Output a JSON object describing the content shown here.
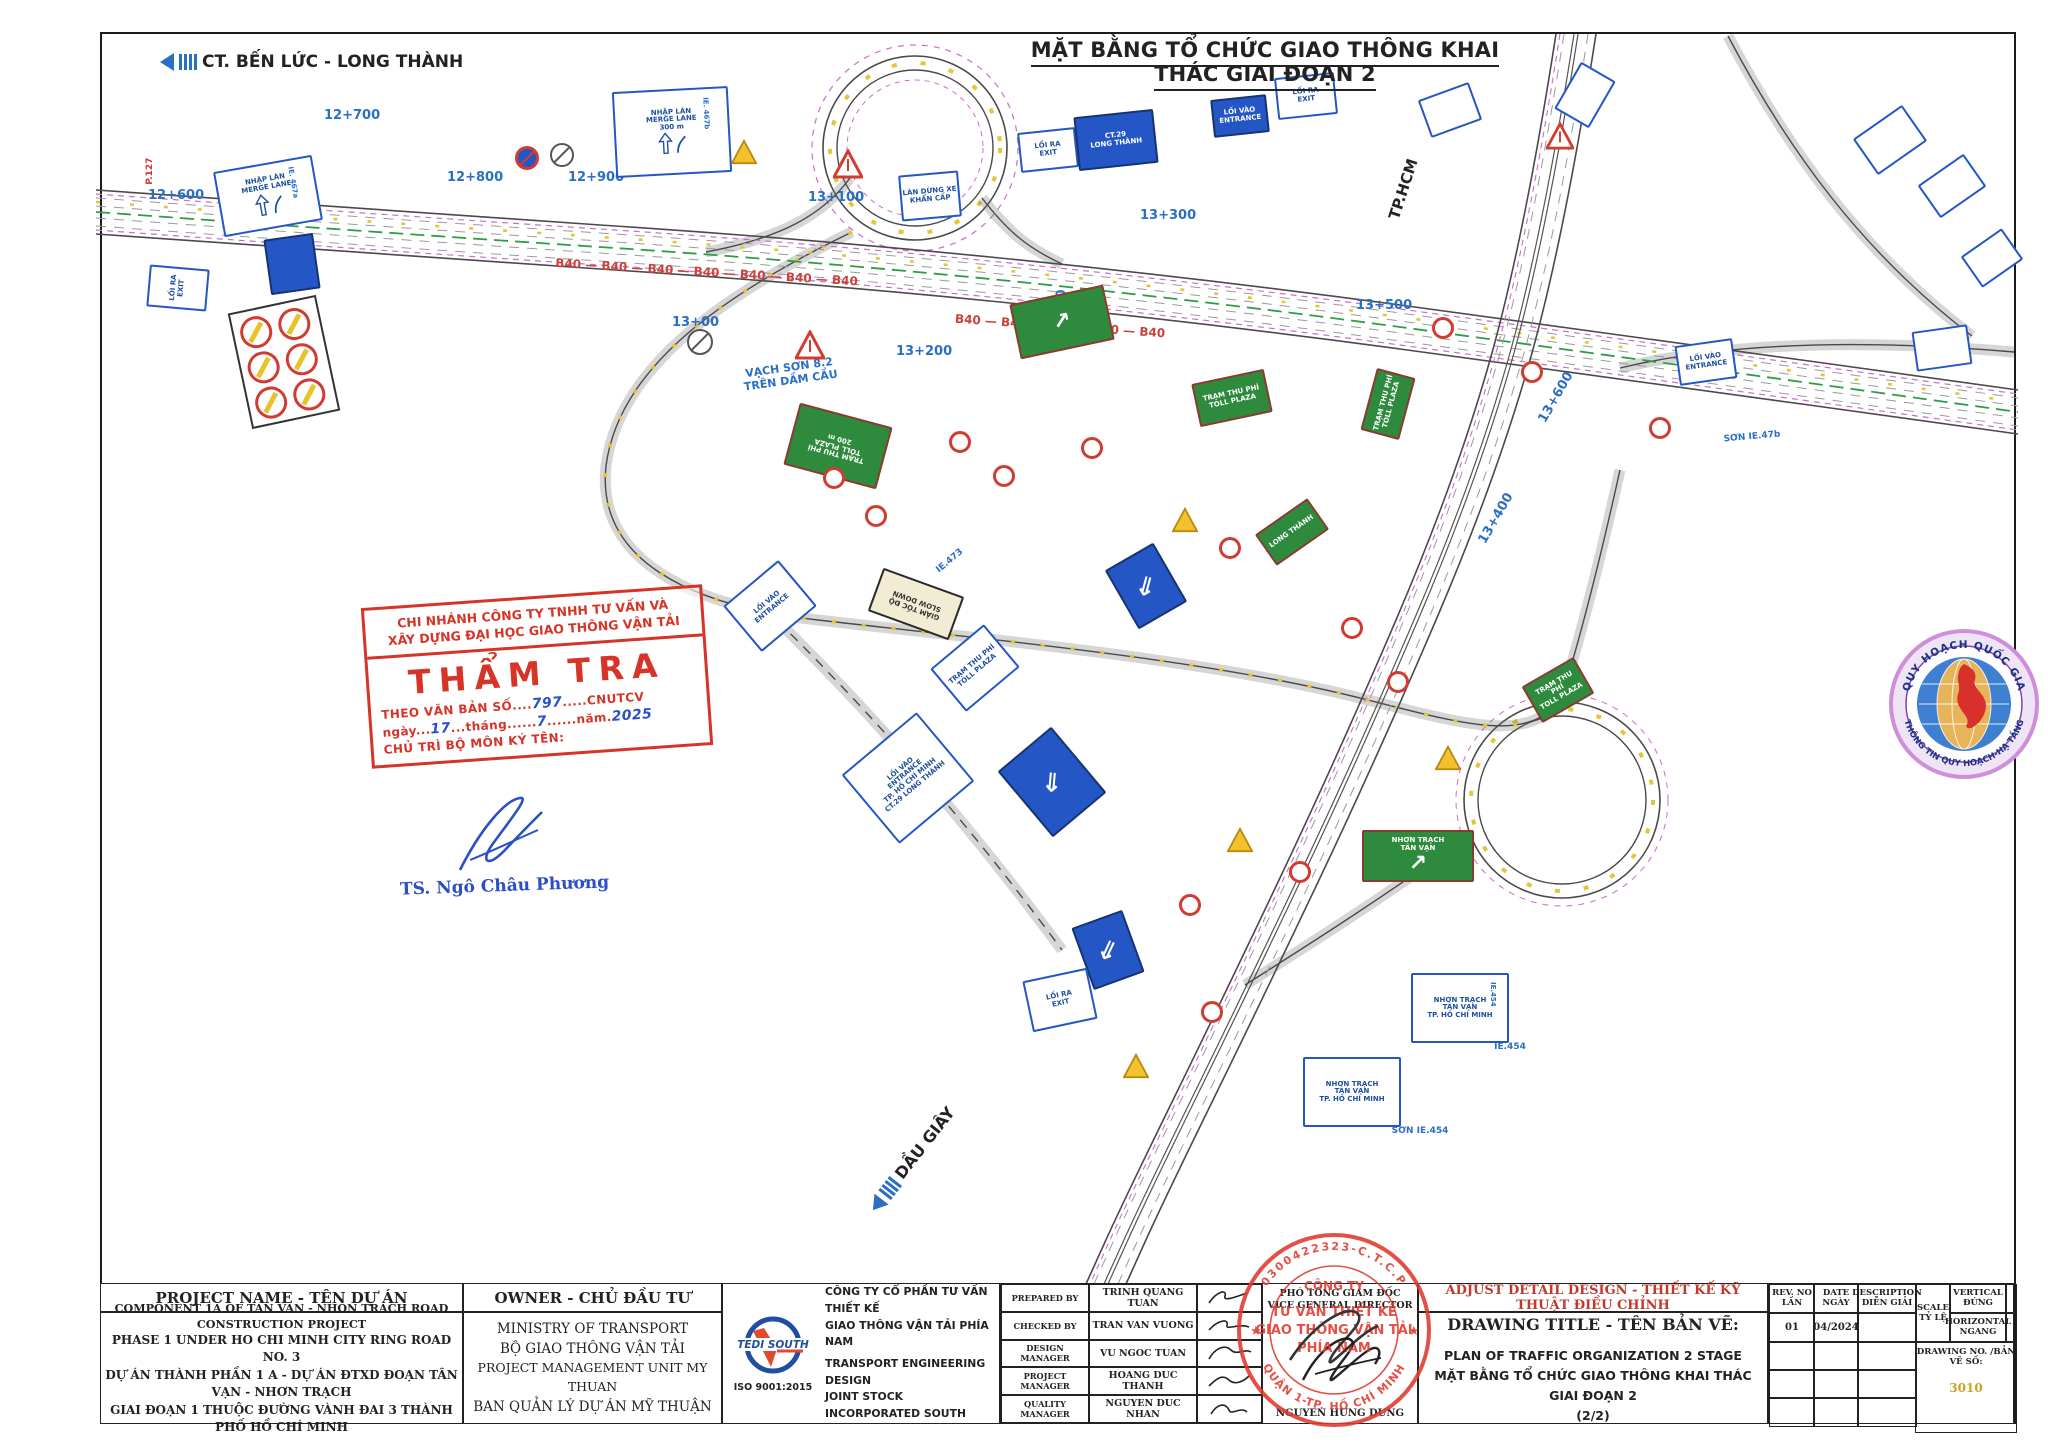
{
  "page": {
    "top_title": "MẶT BẰNG TỔ CHỨC GIAO THÔNG KHAI THÁC GIAI ĐOẠN 2",
    "route_top_left": "CT. BẾN LỨC - LONG THÀNH",
    "route_bottom": "DẦU GIÂY",
    "route_tphcm": "TP.HCM"
  },
  "plan": {
    "chainages": [
      {
        "t": "12+600",
        "x": 176,
        "y": 196,
        "r": 0
      },
      {
        "t": "12+700",
        "x": 352,
        "y": 116,
        "r": 0
      },
      {
        "t": "12+800",
        "x": 475,
        "y": 178,
        "r": 0
      },
      {
        "t": "12+900",
        "x": 596,
        "y": 178,
        "r": 0
      },
      {
        "t": "13+00",
        "x": 700,
        "y": 323,
        "r": 0
      },
      {
        "t": "13+100",
        "x": 836,
        "y": 198,
        "r": 0
      },
      {
        "t": "13+200",
        "x": 924,
        "y": 352,
        "r": 0
      },
      {
        "t": "13+300",
        "x": 1168,
        "y": 216,
        "r": 0
      },
      {
        "t": "13+300",
        "x": 1062,
        "y": 318,
        "r": -90
      },
      {
        "t": "13+400",
        "x": 1496,
        "y": 519,
        "r": -60
      },
      {
        "t": "13+500",
        "x": 1384,
        "y": 306,
        "r": 0
      },
      {
        "t": "13+600",
        "x": 1556,
        "y": 398,
        "r": -60
      }
    ],
    "texts": [
      {
        "t": "VẠCH SƠN 8.2\nTRÊN DẦM CẦU",
        "x": 790,
        "y": 372,
        "r": -8,
        "c": "#2b6fc4",
        "s": 11,
        "b": 1
      },
      {
        "t": "SƠN IE.47b",
        "x": 1752,
        "y": 442,
        "r": -5,
        "c": "#2b6fc4",
        "s": 9,
        "b": 1
      },
      {
        "t": "IE.473",
        "x": 950,
        "y": 566,
        "r": -40,
        "c": "#2b6fc4",
        "s": 9,
        "b": 1
      },
      {
        "t": "SƠN IE.454",
        "x": 1420,
        "y": 1136,
        "r": 0,
        "c": "#2b6fc4",
        "s": 9,
        "b": 1
      },
      {
        "t": "IE.454",
        "x": 1510,
        "y": 1052,
        "r": 0,
        "c": "#2b6fc4",
        "s": 9,
        "b": 1
      },
      {
        "t": "P.127",
        "x": 150,
        "y": 176,
        "r": -90,
        "c": "#cc3333",
        "s": 9,
        "b": 1
      },
      {
        "t": "B40 — B40 — B40 — B40 — B40 — B40 — B40",
        "x": 705,
        "y": 276,
        "r": 3.5,
        "c": "#c8443c",
        "s": 12,
        "b": 1
      },
      {
        "t": "B40 — B40 — B40 — B40 — B40",
        "x": 1060,
        "y": 330,
        "r": 4,
        "c": "#c8443c",
        "s": 12,
        "b": 1
      }
    ],
    "signs": [
      {
        "k": "b",
        "x": 268,
        "y": 196,
        "w": 100,
        "h": 66,
        "r": -10,
        "t": [
          "NHẬP LÀN",
          "MERGE LANE"
        ],
        "tag": "IE. 467a",
        "glyph": "merge"
      },
      {
        "k": "b",
        "x": 672,
        "y": 132,
        "w": 116,
        "h": 86,
        "r": -3,
        "t": [
          "NHẬP LÀN",
          "MERGE LANE",
          "300 m"
        ],
        "tag": "IE. 467b",
        "glyph": "merge"
      },
      {
        "k": "b",
        "x": 930,
        "y": 196,
        "w": 60,
        "h": 46,
        "r": -5,
        "t": [
          "LÀN DỪNG XE",
          "KHẨN CẤP"
        ]
      },
      {
        "k": "b",
        "x": 1048,
        "y": 150,
        "w": 58,
        "h": 40,
        "r": -6,
        "t": [
          "LỐI RA",
          "EXIT"
        ]
      },
      {
        "k": "bf",
        "x": 1116,
        "y": 140,
        "w": 80,
        "h": 54,
        "r": -6,
        "t": [
          "CT.29",
          "LONG THÀNH"
        ]
      },
      {
        "k": "bf",
        "x": 1240,
        "y": 116,
        "w": 56,
        "h": 38,
        "r": -6,
        "t": [
          "LỐI VÀO",
          "ENTRANCE"
        ]
      },
      {
        "k": "b",
        "x": 1306,
        "y": 96,
        "w": 60,
        "h": 42,
        "r": -6,
        "t": [
          "LỐI RA",
          "EXIT"
        ]
      },
      {
        "k": "b",
        "x": 1450,
        "y": 110,
        "w": 54,
        "h": 40,
        "r": -20,
        "t": [
          ""
        ]
      },
      {
        "k": "b",
        "x": 1585,
        "y": 95,
        "w": 54,
        "h": 40,
        "r": -60,
        "t": [
          ""
        ]
      },
      {
        "k": "wt",
        "x": 848,
        "y": 164,
        "s": 30
      },
      {
        "k": "wt",
        "x": 810,
        "y": 345,
        "s": 30
      },
      {
        "k": "wt",
        "x": 1560,
        "y": 136,
        "s": 28
      },
      {
        "k": "yt",
        "x": 744,
        "y": 152,
        "s": 26
      },
      {
        "k": "yt",
        "x": 1185,
        "y": 520,
        "s": 26
      },
      {
        "k": "yt",
        "x": 1240,
        "y": 840,
        "s": 26
      },
      {
        "k": "yt",
        "x": 1136,
        "y": 1066,
        "s": 26
      },
      {
        "k": "yt",
        "x": 1448,
        "y": 758,
        "s": 26
      },
      {
        "k": "nb",
        "x": 527,
        "y": 158,
        "s": 24
      },
      {
        "k": "gc",
        "x": 562,
        "y": 155,
        "s": 24
      },
      {
        "k": "gc",
        "x": 700,
        "y": 342,
        "s": 26
      },
      {
        "k": "g",
        "x": 838,
        "y": 446,
        "w": 96,
        "h": 64,
        "r": 195,
        "t": [
          "TRẠM THU PHÍ",
          "TOLL PLAZA",
          "200 m"
        ]
      },
      {
        "k": "g",
        "x": 1062,
        "y": 322,
        "w": 96,
        "h": 56,
        "r": -12,
        "t": [
          ""
        ],
        "glyph": "garr"
      },
      {
        "k": "g",
        "x": 1232,
        "y": 398,
        "w": 74,
        "h": 44,
        "r": -12,
        "t": [
          "TRẠM THU PHÍ",
          "TOLL PLAZA"
        ]
      },
      {
        "k": "g",
        "x": 1388,
        "y": 404,
        "w": 64,
        "h": 40,
        "r": -75,
        "t": [
          "TRẠM THU PHÍ",
          "TOLL PLAZA"
        ]
      },
      {
        "k": "g",
        "x": 1292,
        "y": 532,
        "w": 64,
        "h": 38,
        "r": -35,
        "t": [
          "LONG THÀNH"
        ]
      },
      {
        "k": "g",
        "x": 1558,
        "y": 690,
        "w": 60,
        "h": 42,
        "r": -30,
        "t": [
          "TRẠM THU PHÍ",
          "TOLL PLAZA"
        ]
      },
      {
        "k": "g",
        "x": 1418,
        "y": 856,
        "w": 112,
        "h": 52,
        "r": 0,
        "t": [
          "NHƠN TRẠCH",
          "TÂN VẠN"
        ],
        "glyph": "garr"
      },
      {
        "k": "bg",
        "x": 916,
        "y": 604,
        "w": 86,
        "h": 46,
        "r": 200,
        "t": [
          "GIẢM TỐC ĐỘ",
          "SLOW DOWN"
        ]
      },
      {
        "k": "b",
        "x": 908,
        "y": 778,
        "w": 98,
        "h": 90,
        "r": -40,
        "t": [
          "LỐI VÀO",
          "ENTRANCE",
          "TP. HỒ CHÍ MINH",
          "CT.29 LONG THÀNH"
        ]
      },
      {
        "k": "arr",
        "x": 1052,
        "y": 782,
        "w": 70,
        "h": 86,
        "r": -40
      },
      {
        "k": "arr",
        "x": 1146,
        "y": 586,
        "w": 56,
        "h": 68,
        "r": -30
      },
      {
        "k": "arr",
        "x": 1108,
        "y": 950,
        "w": 54,
        "h": 66,
        "r": -20
      },
      {
        "k": "b",
        "x": 975,
        "y": 668,
        "w": 70,
        "h": 56,
        "r": -40,
        "t": [
          "TRẠM THU PHÍ",
          "TOLL PLAZA"
        ]
      },
      {
        "k": "b",
        "x": 770,
        "y": 606,
        "w": 72,
        "h": 60,
        "r": -40,
        "t": [
          "LỐI VÀO",
          "ENTRANCE"
        ]
      },
      {
        "k": "b",
        "x": 1060,
        "y": 1000,
        "w": 66,
        "h": 52,
        "r": -12,
        "t": [
          "LỐI RA",
          "EXIT"
        ]
      },
      {
        "k": "b",
        "x": 1460,
        "y": 1008,
        "w": 98,
        "h": 70,
        "r": 0,
        "t": [
          "NHƠN TRẠCH",
          "TÂN VẠN",
          "TP. HỒ CHÍ MINH"
        ],
        "tag": "IE.454"
      },
      {
        "k": "b",
        "x": 1352,
        "y": 1092,
        "w": 98,
        "h": 70,
        "r": 0,
        "t": [
          "NHƠN TRẠCH",
          "TÂN VẠN",
          "TP. HỒ CHÍ MINH"
        ]
      },
      {
        "k": "b",
        "x": 1890,
        "y": 140,
        "w": 60,
        "h": 44,
        "r": -35,
        "t": [
          ""
        ]
      },
      {
        "k": "b",
        "x": 1952,
        "y": 186,
        "w": 56,
        "h": 40,
        "r": -35,
        "t": [
          ""
        ]
      },
      {
        "k": "b",
        "x": 1992,
        "y": 258,
        "w": 50,
        "h": 38,
        "r": -35,
        "t": [
          ""
        ]
      },
      {
        "k": "b",
        "x": 1706,
        "y": 362,
        "w": 58,
        "h": 40,
        "r": -8,
        "t": [
          "LỐI VÀO",
          "ENTRANCE"
        ]
      },
      {
        "k": "b",
        "x": 1942,
        "y": 348,
        "w": 56,
        "h": 40,
        "r": -8,
        "t": [
          ""
        ]
      },
      {
        "k": "b",
        "x": 178,
        "y": 288,
        "w": 42,
        "h": 60,
        "r": -85,
        "t": [
          "LỐI RA",
          "EXIT"
        ]
      },
      {
        "k": "bf",
        "x": 292,
        "y": 264,
        "w": 50,
        "h": 56,
        "r": -8,
        "t": [
          ""
        ]
      },
      {
        "k": "pn",
        "x": 284,
        "y": 362,
        "w": 90,
        "h": 118,
        "r": -12
      },
      {
        "k": "rc",
        "x": 834,
        "y": 478,
        "s": 22
      },
      {
        "k": "rc",
        "x": 876,
        "y": 516,
        "s": 22
      },
      {
        "k": "rc",
        "x": 960,
        "y": 442,
        "s": 22
      },
      {
        "k": "rc",
        "x": 1004,
        "y": 476,
        "s": 22
      },
      {
        "k": "rc",
        "x": 1092,
        "y": 448,
        "s": 22
      },
      {
        "k": "rc",
        "x": 1230,
        "y": 548,
        "s": 22
      },
      {
        "k": "rc",
        "x": 1352,
        "y": 628,
        "s": 22
      },
      {
        "k": "rc",
        "x": 1398,
        "y": 682,
        "s": 22
      },
      {
        "k": "rc",
        "x": 1300,
        "y": 872,
        "s": 22
      },
      {
        "k": "rc",
        "x": 1212,
        "y": 1012,
        "s": 22
      },
      {
        "k": "rc",
        "x": 1443,
        "y": 328,
        "s": 22
      },
      {
        "k": "rc",
        "x": 1660,
        "y": 428,
        "s": 22
      },
      {
        "k": "rc",
        "x": 1532,
        "y": 372,
        "s": 22
      },
      {
        "k": "rc",
        "x": 1190,
        "y": 905,
        "s": 22
      }
    ]
  },
  "verify_stamp": {
    "line1": "CHI NHÁNH CÔNG TY TNHH TƯ VẤN VÀ",
    "line2": "XÂY DỰNG ĐẠI HỌC GIAO THÔNG VẬN TẢI",
    "title": "THẨM TRA",
    "doc_pre": "THEO VĂN BẢN SỐ....",
    "doc_no": "797",
    "doc_post": ".....CNUTCV",
    "date_pre": "ngày...",
    "date_day": "17",
    "date_mid": "...tháng......",
    "date_month": "7",
    "date_mid2": "......năm.",
    "date_year": "2025",
    "sign_label": "CHỦ TRÌ BỘ MÔN KÝ TÊN:",
    "signer": "TS. Ngô Châu Phương"
  },
  "planning_seal": {
    "arc_top": "QUY HOẠCH QUỐC GIA",
    "arc_bottom": "THÔNG TIN QUY HOẠCH-HẠ TẦNG"
  },
  "company_stamp": {
    "arc_top": "0300422323-C.T.C.P",
    "center1": "CÔNG TY",
    "center2": "TƯ VẤN THIẾT KẾ",
    "center3": "GIAO THÔNG VẬN TẢI",
    "center4": "PHÍA NAM",
    "arc_bottom": "QUẬN 1-TP. HỒ CHÍ MINH"
  },
  "titleblock": {
    "project": {
      "header": "PROJECT NAME - TÊN DỰ ÁN",
      "lines": [
        "COMPONENT 1A OF TAN VAN - NHON TRACH ROAD CONSTRUCTION PROJECT",
        "PHASE 1 UNDER HO CHI MINH CITY RING ROAD NO. 3",
        "DỰ ÁN THÀNH PHẦN 1 A - DỰ ÁN ĐTXD ĐOẠN  TÂN VẠN - NHƠN TRẠCH",
        "GIAI ĐOẠN 1 THUỘC ĐƯỜNG VÀNH ĐAI 3 THÀNH PHỐ HỒ CHÍ MINH"
      ]
    },
    "owner": {
      "header": "OWNER - CHỦ ĐẦU TƯ",
      "lines": [
        "MINISTRY OF TRANSPORT",
        "BỘ GIAO THÔNG VẬN TẢI",
        "PROJECT MANAGEMENT UNIT MY THUAN",
        "BAN QUẢN LÝ DỰ ÁN MỸ THUẬN"
      ]
    },
    "company": {
      "logo_text": "TEDI SOUTH",
      "iso": "ISO 9001:2015",
      "lines": [
        "CÔNG TY CỔ PHẦN TƯ VẤN THIẾT KẾ",
        "GIAO THÔNG VẬN TẢI PHÍA NAM",
        "TRANSPORT ENGINEERING DESIGN",
        "JOINT STOCK INCORPORATED SOUTH"
      ]
    },
    "approvals": [
      {
        "role": "PREPARED BY",
        "name": "TRINH QUANG TUAN"
      },
      {
        "role": "CHECKED BY",
        "name": "TRAN VAN VUONG"
      },
      {
        "role": "DESIGN MANAGER",
        "name": "VU NGOC TUAN"
      },
      {
        "role": "PROJECT MANAGER",
        "name": "HOANG DUC THANH"
      },
      {
        "role": "QUALITY MANAGER",
        "name": "NGUYEN DUC NHAN"
      }
    ],
    "director": {
      "title_vn": "PHÓ TỔNG GIÁM ĐỐC",
      "title_en": "VICE GENERAL DIRECTOR",
      "name": "NGUYEN HUNG DUNG"
    },
    "drawing": {
      "red_header": "ADJUST DETAIL DESIGN - THIẾT KẾ KỸ THUẬT ĐIỀU CHỈNH",
      "title_label": "DRAWING TITLE - TÊN BẢN VẼ:",
      "line1": "PLAN OF TRAFFIC ORGANIZATION 2 STAGE",
      "line2": "MẶT BẰNG TỔ CHỨC GIAO THÔNG KHAI THÁC GIAI ĐOẠN 2",
      "line3": "(2/2)"
    },
    "rev": {
      "h_rev": "REV. NO",
      "h_rev2": "LẦN",
      "h_date": "DATE",
      "h_date2": "NGÀY",
      "h_desc": "DESCRIPTION",
      "h_desc2": "DIỄN GIẢI",
      "rev_val": "01",
      "date_val": "04/2024",
      "desc_val": ""
    },
    "scale": {
      "label1": "SCALE",
      "label2": "TỶ LỆ",
      "vert1": "VERTICAL",
      "vert2": "ĐỨNG",
      "horz1": "HORIZONTAL",
      "horz2": "NGANG"
    },
    "drawing_no": {
      "label": "DRAWING NO. /BẢN VẼ SỐ:",
      "value": "3010"
    }
  }
}
